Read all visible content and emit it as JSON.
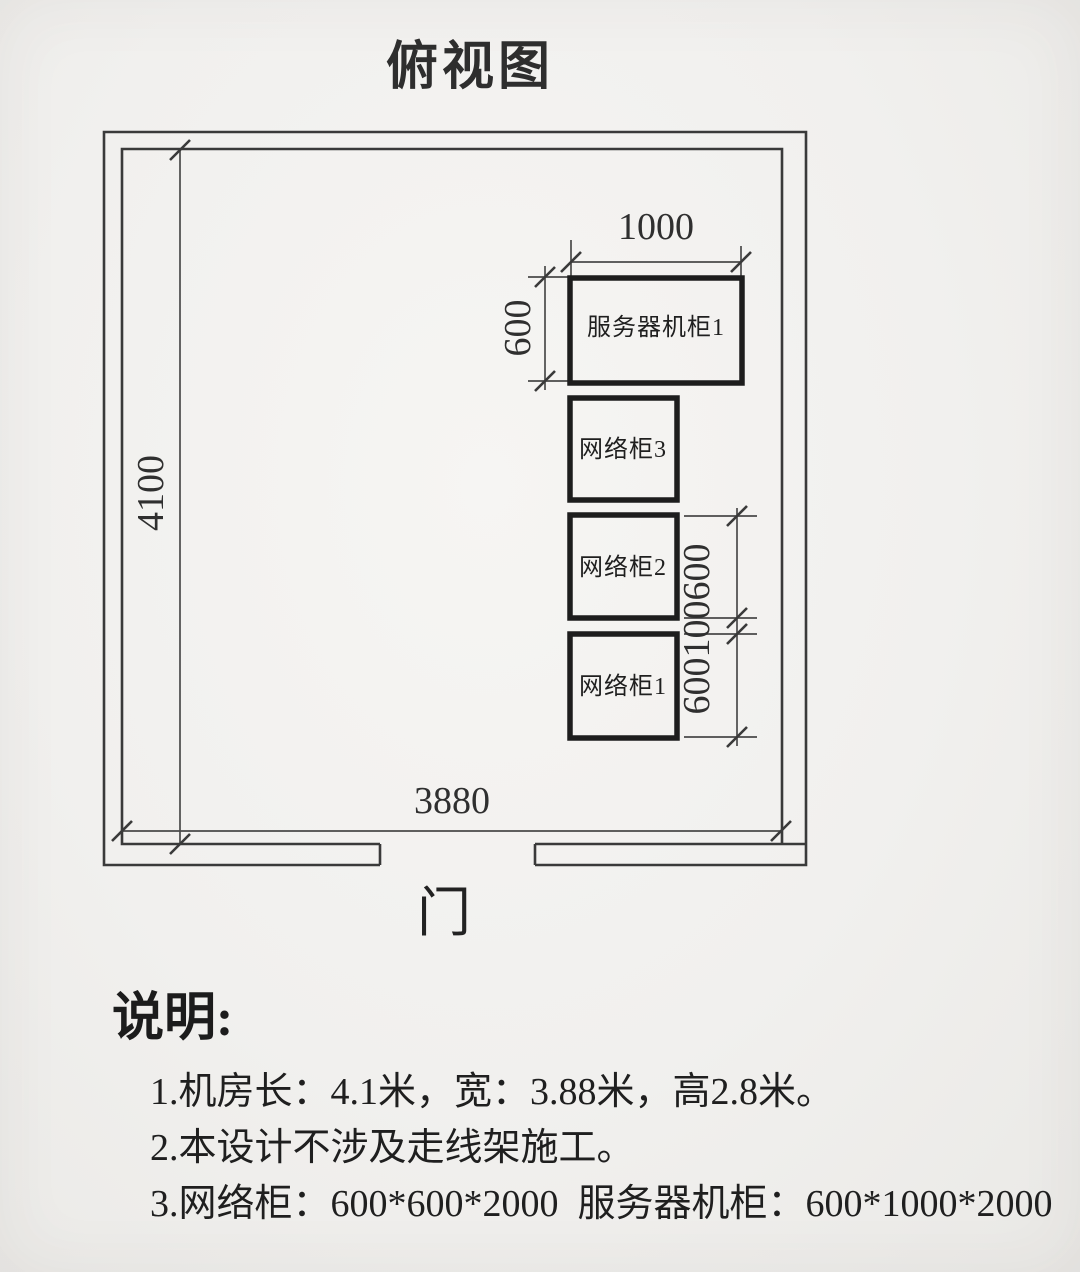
{
  "colors": {
    "paper": "#f1f0ee",
    "ink": "#2e2e2e"
  },
  "title": "俯视图",
  "room": {
    "length_label": "4100",
    "width_label": "3880",
    "door_label": "门"
  },
  "cabinets": {
    "server": {
      "label": "服务器机柜1",
      "width_label": "1000",
      "depth_label": "600"
    },
    "network": [
      {
        "label": "网络柜3"
      },
      {
        "label": "网络柜2"
      },
      {
        "label": "网络柜1"
      }
    ],
    "spacing_labels": [
      "600",
      "100",
      "600"
    ]
  },
  "notes": {
    "heading": "说明:",
    "items": [
      "1.机房长：4.1米，宽：3.88米，高2.8米。",
      "2.本设计不涉及走线架施工。",
      "3.网络柜：600*600*2000  服务器机柜：600*1000*2000"
    ]
  }
}
